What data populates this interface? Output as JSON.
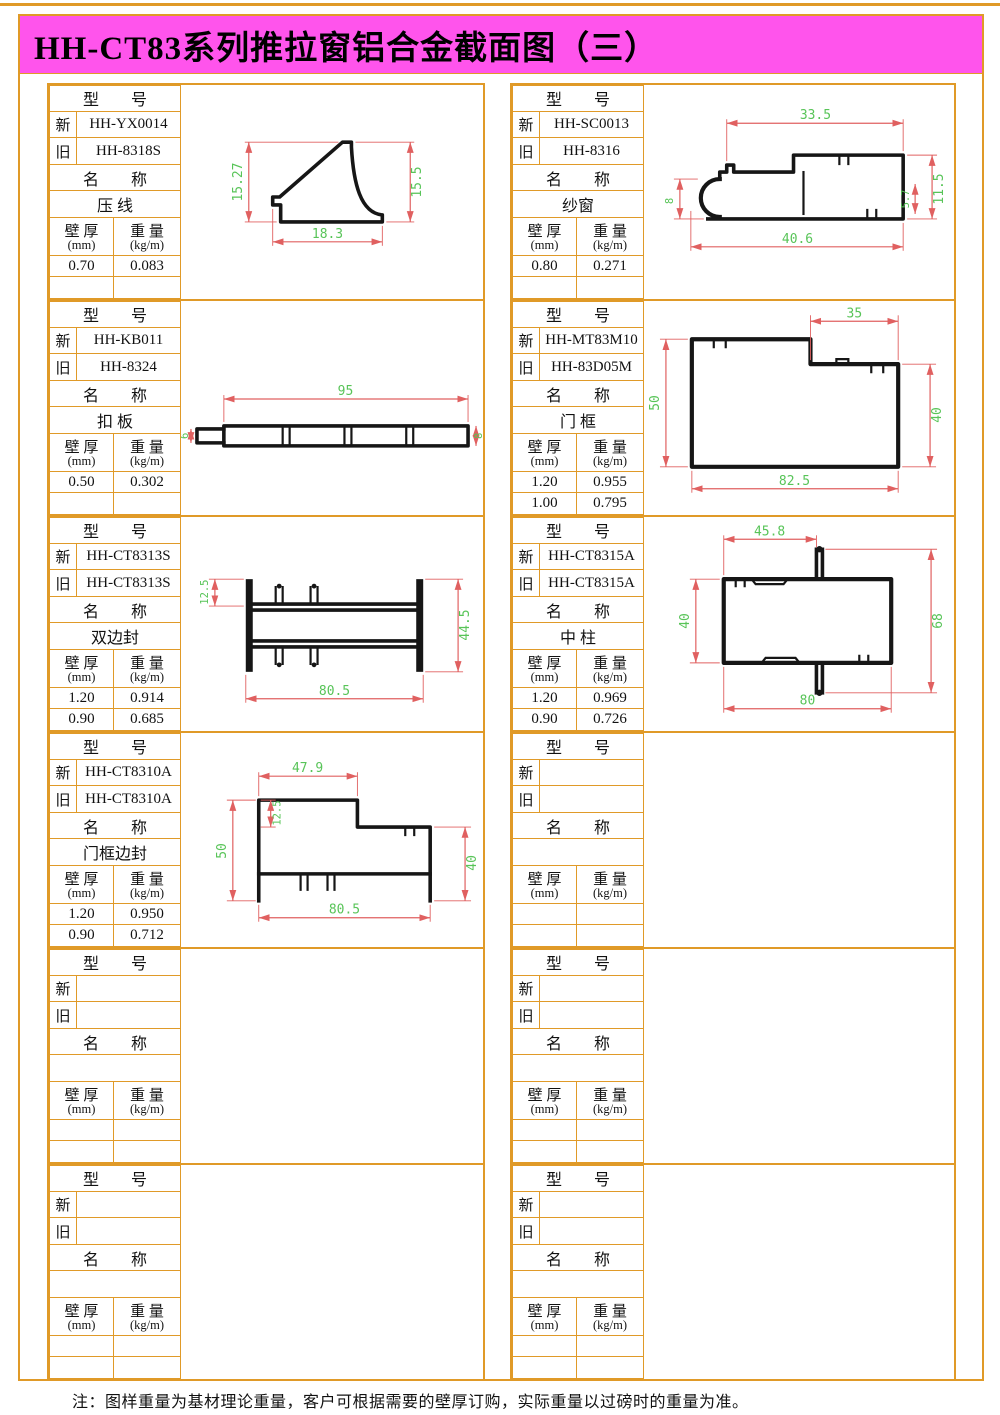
{
  "title": "HH-CT83系列推拉窗铝合金截面图（三）",
  "footnote": "注：图样重量为基材理论重量，客户可根据需要的壁厚订购，实际重量以过磅时的重量为准。",
  "labels": {
    "model": "型　　号",
    "new": "新",
    "old": "旧",
    "name": "名　　称",
    "th1": "壁 厚",
    "th2": "(mm)",
    "wt1": "重 量",
    "wt2": "(kg/m)"
  },
  "colors": {
    "border_orange": "#E09A28",
    "header_magenta": "#FF54EC",
    "dim_line_red": "#E06060",
    "dim_text_green": "#58C458",
    "profile_black": "#161616"
  },
  "cells": [
    {
      "new": "HH-YX0014",
      "old": "HH-8318S",
      "name": "压 线",
      "rows": [
        {
          "t": "0.70",
          "w": "0.083"
        },
        {
          "t": "",
          "w": ""
        }
      ],
      "dims": {
        "left": "15.27",
        "right": "15.5",
        "bottom": "18.3"
      }
    },
    {
      "new": "HH-SC0013",
      "old": "HH-8316",
      "name": "纱窗",
      "rows": [
        {
          "t": "0.80",
          "w": "0.271"
        },
        {
          "t": "",
          "w": ""
        }
      ],
      "dims": {
        "top": "33.5",
        "left": "8",
        "right": "11.5",
        "inner": "5.7",
        "bottom": "40.6"
      }
    },
    {
      "new": "HH-KB011",
      "old": "HH-8324",
      "name": "扣 板",
      "rows": [
        {
          "t": "0.50",
          "w": "0.302"
        },
        {
          "t": "",
          "w": ""
        }
      ],
      "dims": {
        "top": "95",
        "left": "6",
        "right": "8"
      }
    },
    {
      "new": "HH-MT83M10",
      "old": "HH-83D05M",
      "name": "门 框",
      "rows": [
        {
          "t": "1.20",
          "w": "0.955"
        },
        {
          "t": "1.00",
          "w": "0.795"
        }
      ],
      "dims": {
        "top": "35",
        "left": "50",
        "right": "40",
        "bottom": "82.5"
      }
    },
    {
      "new": "HH-CT8313S",
      "old": "HH-CT8313S",
      "name": "双边封",
      "rows": [
        {
          "t": "1.20",
          "w": "0.914"
        },
        {
          "t": "0.90",
          "w": "0.685"
        }
      ],
      "dims": {
        "top": "12.5",
        "right": "44.5",
        "bottom": "80.5"
      }
    },
    {
      "new": "HH-CT8315A",
      "old": "HH-CT8315A",
      "name": "中 柱",
      "rows": [
        {
          "t": "1.20",
          "w": "0.969"
        },
        {
          "t": "0.90",
          "w": "0.726"
        }
      ],
      "dims": {
        "top": "45.8",
        "left": "40",
        "right": "68",
        "bottom": "80"
      }
    },
    {
      "new": "HH-CT8310A",
      "old": "HH-CT8310A",
      "name": "门框边封",
      "rows": [
        {
          "t": "1.20",
          "w": "0.950"
        },
        {
          "t": "0.90",
          "w": "0.712"
        }
      ],
      "dims": {
        "top": "47.9",
        "left": "50",
        "inner": "12.5",
        "right": "40",
        "bottom": "80.5"
      }
    },
    {
      "new": "",
      "old": "",
      "name": "",
      "rows": [
        {
          "t": "",
          "w": ""
        },
        {
          "t": "",
          "w": ""
        }
      ],
      "dims": {}
    },
    {
      "new": "",
      "old": "",
      "name": "",
      "rows": [
        {
          "t": "",
          "w": ""
        },
        {
          "t": "",
          "w": ""
        }
      ],
      "dims": {}
    },
    {
      "new": "",
      "old": "",
      "name": "",
      "rows": [
        {
          "t": "",
          "w": ""
        },
        {
          "t": "",
          "w": ""
        }
      ],
      "dims": {}
    },
    {
      "new": "",
      "old": "",
      "name": "",
      "rows": [
        {
          "t": "",
          "w": ""
        },
        {
          "t": "",
          "w": ""
        }
      ],
      "dims": {}
    },
    {
      "new": "",
      "old": "",
      "name": "",
      "rows": [
        {
          "t": "",
          "w": ""
        },
        {
          "t": "",
          "w": ""
        }
      ],
      "dims": {}
    }
  ]
}
